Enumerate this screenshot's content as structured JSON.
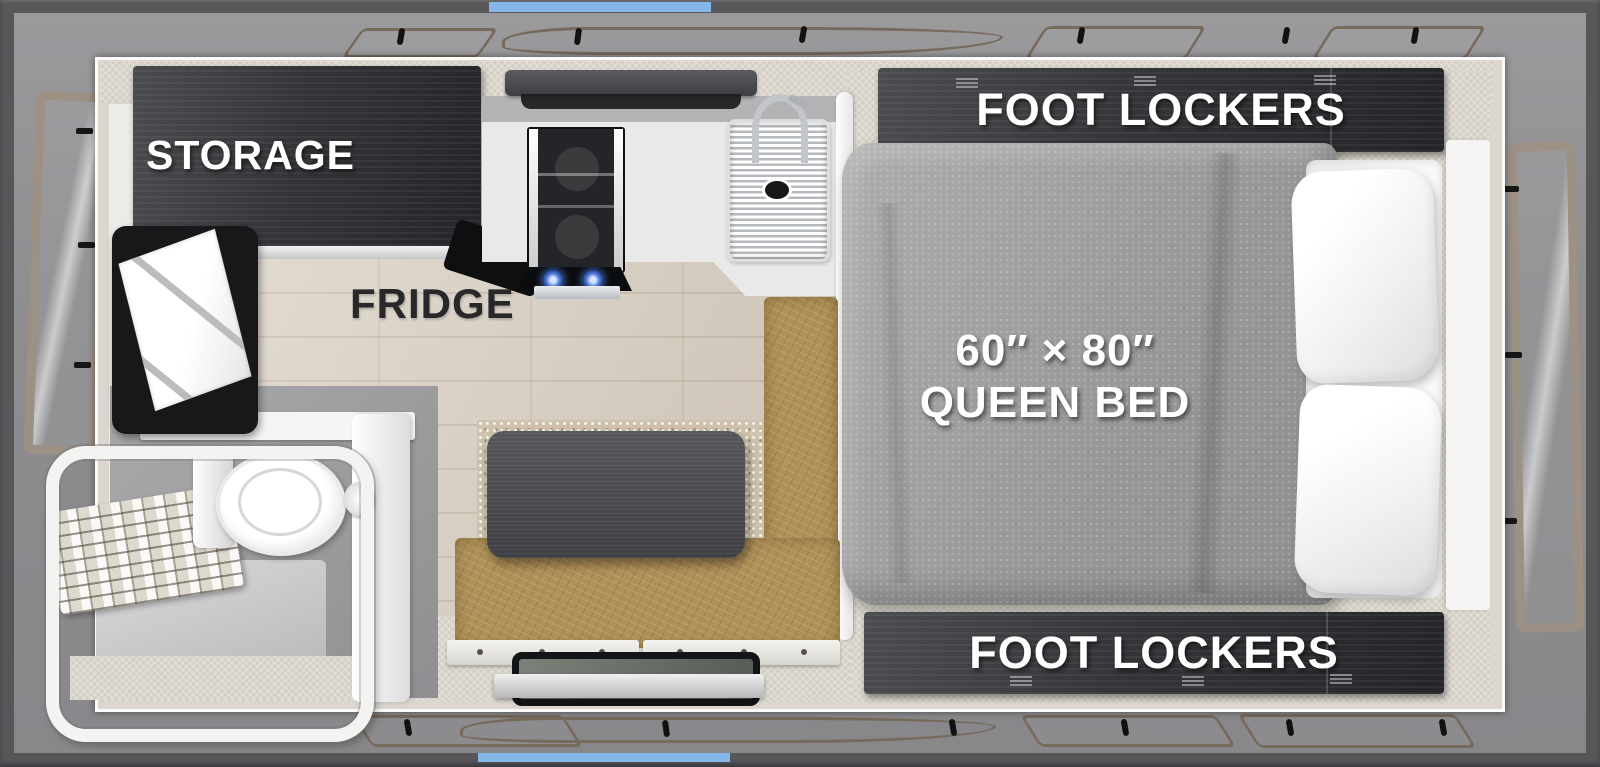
{
  "floorplan": {
    "labels": {
      "storage": "STORAGE",
      "fridge": "FRIDGE",
      "foot_lockers_top": "FOOT LOCKERS",
      "foot_lockers_bottom": "FOOT LOCKERS",
      "bed_size": "60″ × 80″",
      "bed_type": "QUEEN BED"
    },
    "colors": {
      "frame_gray": "#57575a",
      "accent_blue": "#85b8e8",
      "soft_wall_gray": "#8e8e91",
      "canvas_outline_taupe": "#776a5b",
      "wall_fabric_beige": "#dbd7ce",
      "cabinet_dark": "#303235",
      "bench_leather_tan": "#b09158",
      "table_charcoal": "#46484b",
      "mattress_gray": "#9d9d9d",
      "wood_floor": "#d8cec0",
      "carpet_speckled": "#cfc3ad",
      "burner_glow_blue": "#4f79d8",
      "label_white": "#ffffff",
      "label_dark": "#28282b"
    },
    "elements": [
      "storage cabinet",
      "swivel tv",
      "refrigerator",
      "two-burner cooktop",
      "kitchen sink with faucet",
      "kitchen counter",
      "overhead cabinet",
      "wet bath with toilet and shower enclosure",
      "shower shelf rack",
      "dinette table with l-shaped leather bench",
      "entry step",
      "queen bed mattress",
      "two pillows",
      "foot locker cabinets",
      "fold-out canvas soft walls",
      "side access doors",
      "roof accent rails"
    ]
  }
}
